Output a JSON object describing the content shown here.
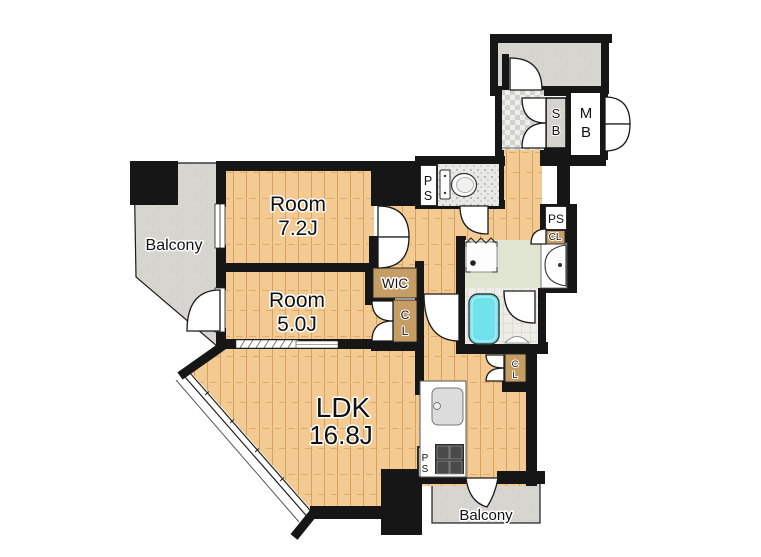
{
  "plan_title": "apartment-floor-plan",
  "rooms": {
    "room1": {
      "name": "Room",
      "size": "7.2J"
    },
    "room2": {
      "name": "Room",
      "size": "5.0J"
    },
    "ldk": {
      "name": "LDK",
      "size": "16.8J"
    },
    "balcony_left": "Balcony",
    "balcony_bottom": "Balcony"
  },
  "storage": {
    "wic": "WIC",
    "cl_room2": [
      "C",
      "L"
    ],
    "cl_ldk": [
      "C",
      "L"
    ],
    "cl_hall": "CL",
    "sb": [
      "S",
      "B"
    ],
    "mb": [
      "M",
      "B"
    ]
  },
  "shafts": {
    "ps_toilet": [
      "P",
      "S"
    ],
    "ps_hall": "PS",
    "ps_kitchen": [
      "P",
      "S"
    ]
  },
  "colors": {
    "wall": "#161616",
    "wood": "#f3ca92",
    "balcony_gray": "#d6d5d0",
    "closet_tan": "#c79d66",
    "washroom_green": "#e0e5d2",
    "bathtub_cyan": "#6fe2ec",
    "sb_gray": "#d4d3ce"
  }
}
